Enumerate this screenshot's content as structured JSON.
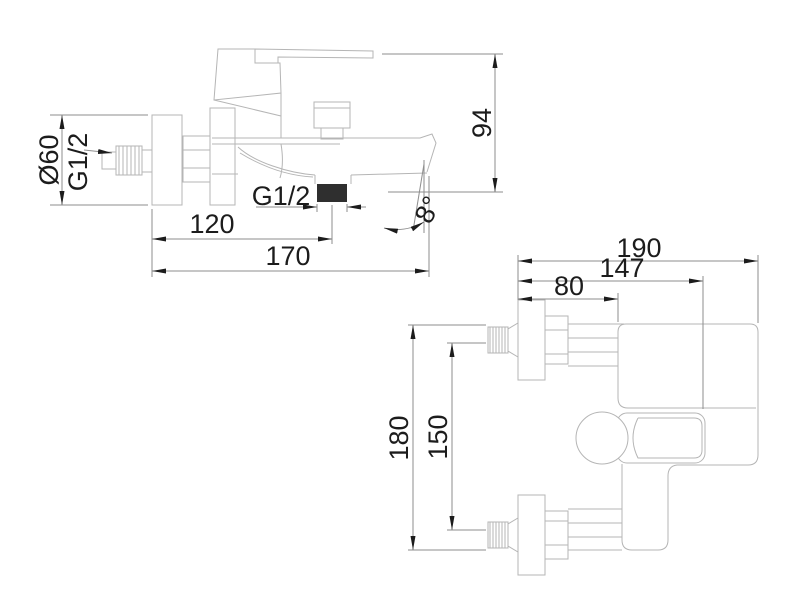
{
  "drawing": {
    "background_color": "#ffffff",
    "geometry_line_color": "#b5b5b5",
    "dimension_line_color": "#8e8e8e",
    "text_color": "#1c1c1c",
    "outlet_fill_color": "#2f2f2f",
    "side_view": {
      "diameter_label": "Ø60",
      "inlet_thread_label": "G1/2",
      "height_label": "94",
      "outlet_offset_label": "120",
      "length_label": "170",
      "outlet_thread_label": "G1/2",
      "spout_angle_label": "8°"
    },
    "front_view": {
      "total_width_label": "190",
      "body_width_label": "147",
      "plate_offset_label": "80",
      "total_height_label": "180",
      "inlet_spacing_label": "150"
    }
  }
}
